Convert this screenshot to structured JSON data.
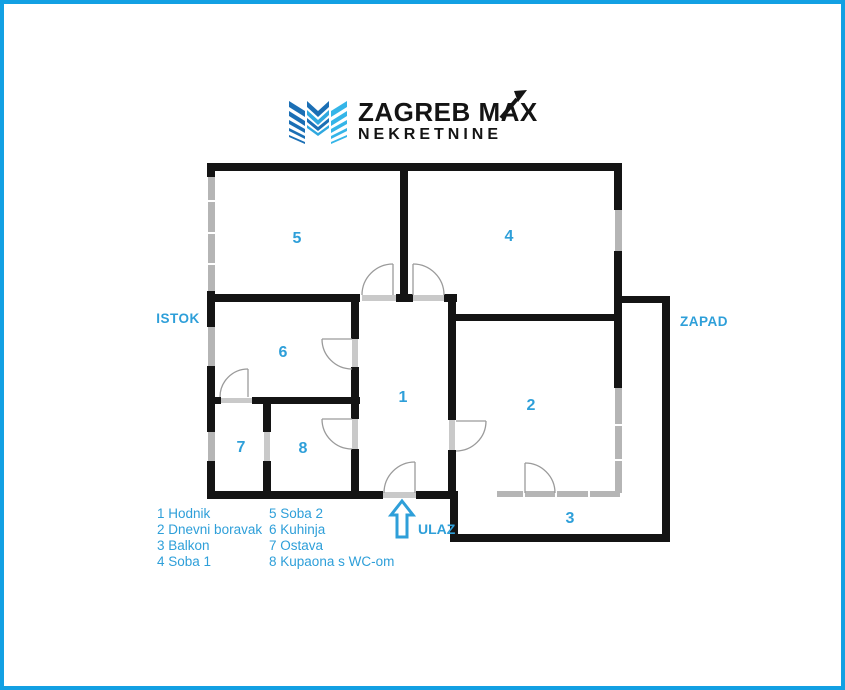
{
  "logo": {
    "brand": "ZAGREB MAX",
    "subbrand": "NEKRETNINE"
  },
  "compass": {
    "east": "ISTOK",
    "west": "ZAPAD"
  },
  "entrance": {
    "label": "ULAZ"
  },
  "rooms": [
    {
      "number": "1",
      "name": "Hodnik"
    },
    {
      "number": "2",
      "name": "Dnevni boravak"
    },
    {
      "number": "3",
      "name": "Balkon"
    },
    {
      "number": "4",
      "name": "Soba 1"
    },
    {
      "number": "5",
      "name": "Soba 2"
    },
    {
      "number": "6",
      "name": "Kuhinja"
    },
    {
      "number": "7",
      "name": "Ostava"
    },
    {
      "number": "8",
      "name": "Kupaona s WC-om"
    }
  ],
  "colors": {
    "accent_blue": "#2E9FD9",
    "frame_border_blue": "#12A0E3",
    "wall_black": "#141414",
    "window_gray": "#b5b5b5",
    "logo_dark_blue": "#1B6FB5",
    "logo_light_blue": "#2FA8DF"
  }
}
